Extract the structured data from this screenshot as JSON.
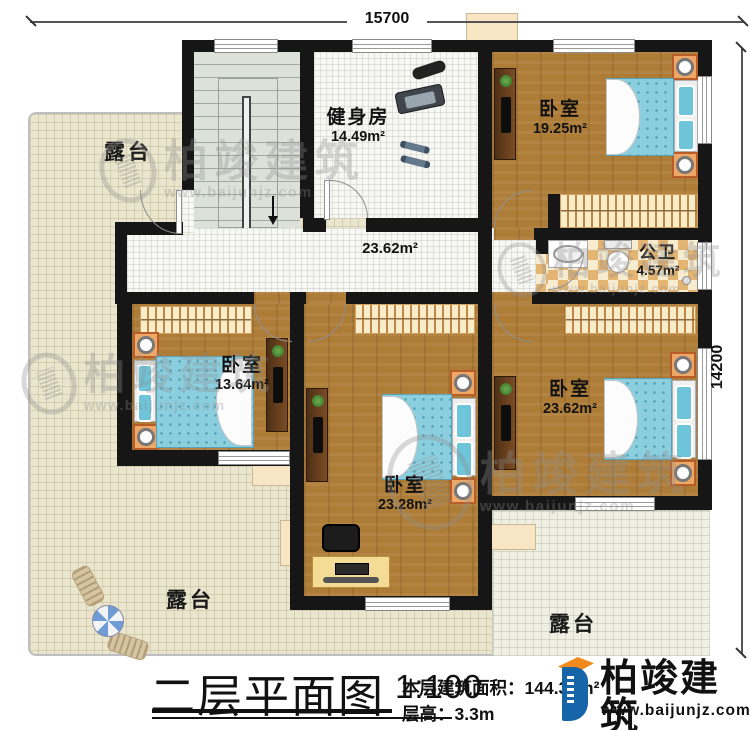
{
  "dimensions": {
    "width_label": "15700",
    "height_label": "14200"
  },
  "rooms": {
    "gym": {
      "name": "健身房",
      "area": "14.49m²"
    },
    "bedroom_ne": {
      "name": "卧室",
      "area": "19.25m²"
    },
    "bathroom": {
      "name": "公卫",
      "area": "4.57m²"
    },
    "hallway": {
      "area": "23.62m²"
    },
    "bedroom_w": {
      "name": "卧室",
      "area": "13.64m²"
    },
    "bedroom_s": {
      "name": "卧室",
      "area": "23.28m²"
    },
    "bedroom_se": {
      "name": "卧室",
      "area": "23.62m²"
    }
  },
  "terraces": {
    "top_left": "露台",
    "bottom_left": "露台",
    "bottom_right": "露台"
  },
  "watermark": {
    "name": "柏竣建筑",
    "website": "www.baijunjz.com"
  },
  "footer": {
    "title": "二层平面图",
    "scale": "1:100",
    "area_label": "本层建筑面积：144.30m²",
    "floor_height_label": "层高：3.3m"
  },
  "brand": {
    "name": "柏竣建筑",
    "website": "www.baijunjz.com"
  }
}
